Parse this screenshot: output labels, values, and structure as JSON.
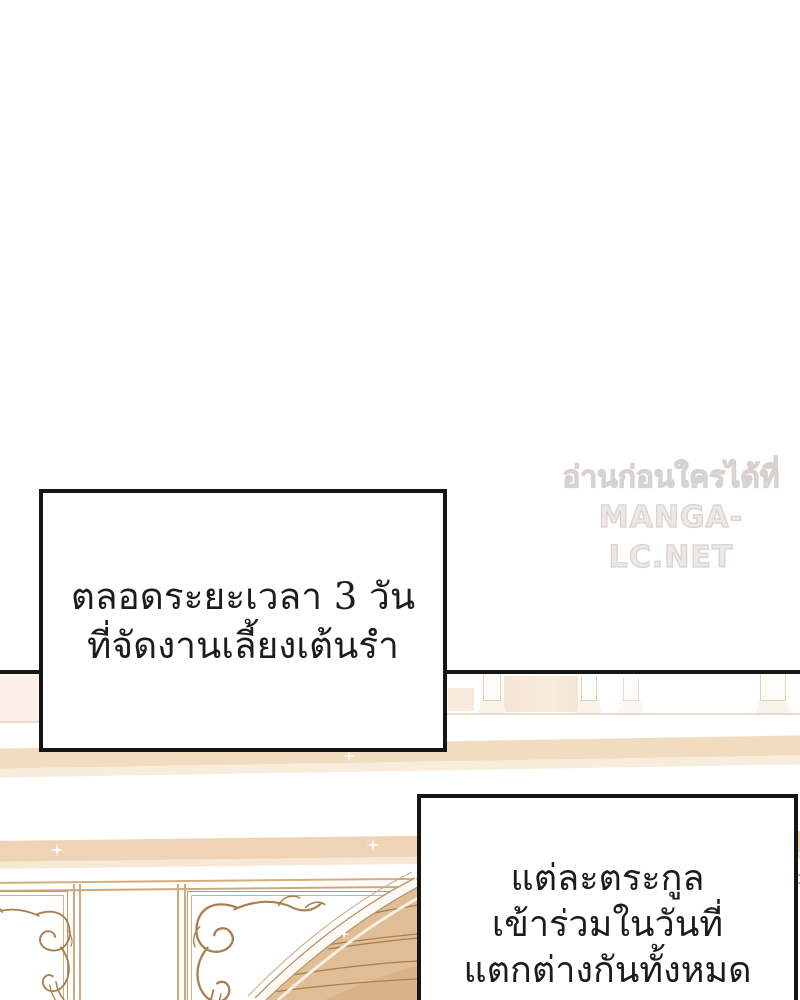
{
  "watermark": {
    "line1": "อ่านก่อนใครได้ที่",
    "line2": "MANGA-LC.NET"
  },
  "captions": {
    "box1": {
      "line1": "ตลอดระยะเวลา 3 วัน",
      "line2": "ที่จัดงานเลี้ยงเต้นรำ"
    },
    "box2": {
      "line1": "แต่ละตระกูล",
      "line2": "เข้าร่วมในวันที่",
      "line3": "แตกต่างกันทั้งหมด"
    }
  },
  "scene": {
    "description": "ballroom interior: distant columns, tan wall moldings, white wall panels with acanthus scroll ornaments and a wooden arched doorway"
  },
  "colors": {
    "panel_border": "#161616",
    "caption_border": "#151515",
    "molding_tan": "#f0d9bd",
    "molding_light": "#f8ecdc",
    "wood_plank": "#e0bd95",
    "wood_plank_dark": "#d9b289",
    "wood_line": "#a97e51",
    "ornament_line": "#ab7e4e",
    "frame_line": "#c2995f",
    "watermark_fill": "#ebe8e6",
    "watermark_outline": "#d7d2cf"
  }
}
